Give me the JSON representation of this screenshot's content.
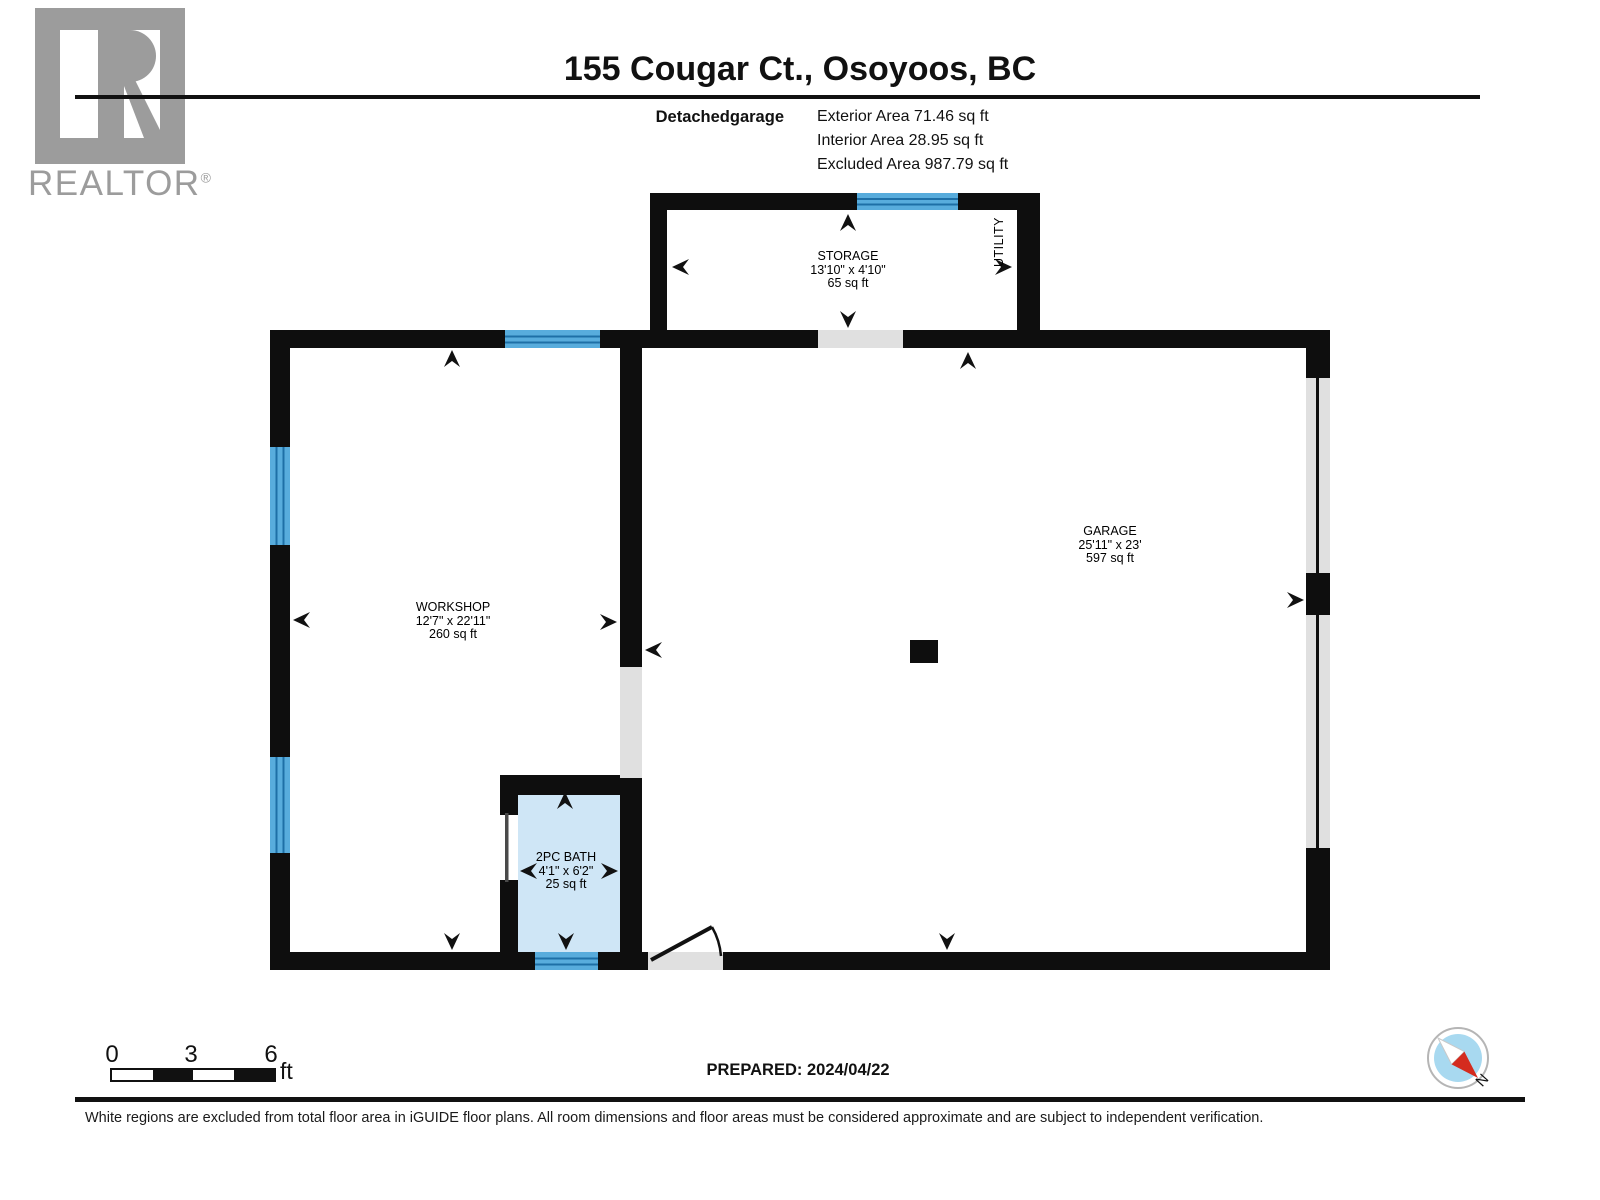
{
  "header": {
    "title": "155 Cougar Ct., Osoyoos, BC",
    "floor_label": "Detachedgarage",
    "exterior_area": "Exterior Area 71.46 sq ft",
    "interior_area": "Interior Area 28.95 sq ft",
    "excluded_area": "Excluded Area 987.79 sq ft"
  },
  "logo": {
    "wordmark": "REALTOR",
    "registered": "®"
  },
  "rooms": {
    "storage": {
      "name": "STORAGE",
      "dims": "13'10\" x 4'10\"",
      "area": "65 sq ft"
    },
    "utility": {
      "name": "UTILITY"
    },
    "workshop": {
      "name": "WORKSHOP",
      "dims": "12'7\" x 22'11\"",
      "area": "260 sq ft"
    },
    "garage": {
      "name": "GARAGE",
      "dims": "25'11\" x 23'",
      "area": "597 sq ft"
    },
    "bath": {
      "name": "2PC BATH",
      "dims": "4'1\" x 6'2\"",
      "area": "25 sq ft"
    }
  },
  "scale": {
    "tick0": "0",
    "tick1": "3",
    "tick2": "6",
    "unit": "ft"
  },
  "footer": {
    "prepared": "PREPARED: 2024/04/22",
    "compass_north": "N",
    "disclaimer": "White regions are excluded from total floor area in iGUIDE floor plans. All room dimensions and floor areas must be considered approximate and are subject to independent verification."
  },
  "colors": {
    "wall_black": "#0e0e0e",
    "window_blue": "#58ACDC",
    "window_line_blue": "#1E6FA6",
    "bath_fill": "#CFE6F6",
    "opening_gray": "#E0E0E0",
    "compass_blue": "#A8D9F0",
    "compass_red": "#D42B1E",
    "logo_gray": "#9c9c9c"
  }
}
